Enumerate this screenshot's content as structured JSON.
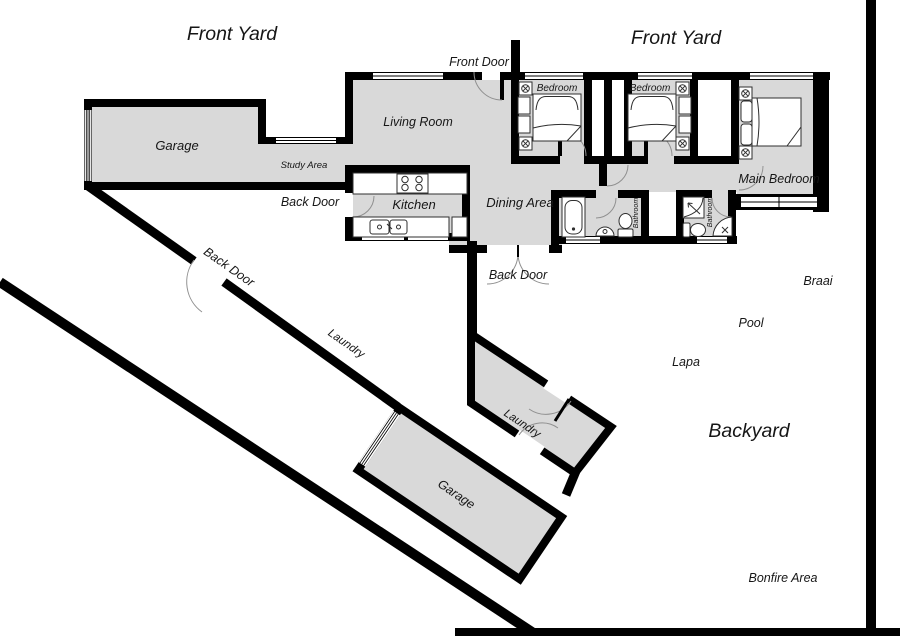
{
  "title": "House Floor Plan",
  "colors": {
    "room_fill": "#d9d9d9",
    "wall": "#000000",
    "background": "#ffffff",
    "door_arc": "#909090"
  },
  "labels": {
    "front_yard_left": {
      "text": "Front Yard"
    },
    "front_yard_right": {
      "text": "Front Yard"
    },
    "front_door": {
      "text": "Front Door"
    },
    "garage_top": {
      "text": "Garage"
    },
    "study_area": {
      "text": "Study Area"
    },
    "living_room": {
      "text": "Living Room"
    },
    "bedroom_1": {
      "text": "Bedroom"
    },
    "bedroom_2": {
      "text": "Bedroom"
    },
    "main_bedroom": {
      "text": "Main Bedroom"
    },
    "kitchen": {
      "text": "Kitchen"
    },
    "dining_area": {
      "text": "Dining Area"
    },
    "back_door_kitchen": {
      "text": "Back Door"
    },
    "back_door_dining": {
      "text": "Back Door"
    },
    "back_door_side": {
      "text": "Back Door"
    },
    "bathroom_1": {
      "text": "Bathroom"
    },
    "bathroom_2": {
      "text": "Bathroom"
    },
    "laundry_corridor": {
      "text": "Laundry"
    },
    "laundry_room": {
      "text": "Laundry"
    },
    "garage_bottom": {
      "text": "Garage"
    },
    "braai": {
      "text": "Braai"
    },
    "pool": {
      "text": "Pool"
    },
    "lapa": {
      "text": "Lapa"
    },
    "backyard": {
      "text": "Backyard"
    },
    "bonfire_area": {
      "text": "Bonfire Area"
    }
  }
}
